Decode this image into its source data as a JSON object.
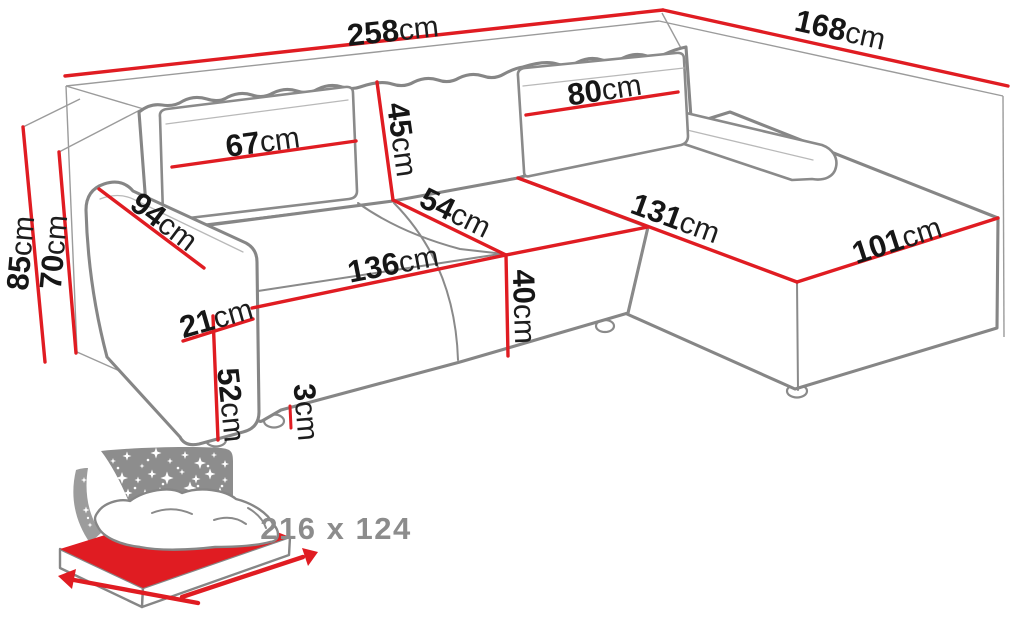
{
  "diagram": {
    "product": "corner-sofa-dimension-diagram",
    "unit": "cm",
    "dimensions": [
      {
        "id": "overall-width",
        "value": "258",
        "unit": "cm"
      },
      {
        "id": "overall-depth",
        "value": "168",
        "unit": "cm"
      },
      {
        "id": "overall-height",
        "value": "85",
        "unit": "cm"
      },
      {
        "id": "backrest-height",
        "value": "70",
        "unit": "cm"
      },
      {
        "id": "back-cushion-width-left",
        "value": "67",
        "unit": "cm"
      },
      {
        "id": "back-cushion-height",
        "value": "45",
        "unit": "cm"
      },
      {
        "id": "back-cushion-width-right",
        "value": "80",
        "unit": "cm"
      },
      {
        "id": "armrest-length",
        "value": "94",
        "unit": "cm"
      },
      {
        "id": "seat-depth",
        "value": "54",
        "unit": "cm"
      },
      {
        "id": "chaise-length",
        "value": "131",
        "unit": "cm"
      },
      {
        "id": "chaise-width",
        "value": "101",
        "unit": "cm"
      },
      {
        "id": "seat-width",
        "value": "136",
        "unit": "cm"
      },
      {
        "id": "seat-height",
        "value": "40",
        "unit": "cm"
      },
      {
        "id": "armrest-width",
        "value": "21",
        "unit": "cm"
      },
      {
        "id": "armrest-height",
        "value": "52",
        "unit": "cm"
      },
      {
        "id": "leg-height",
        "value": "3",
        "unit": "cm"
      }
    ],
    "sleeping_area": {
      "label": "216 x 124",
      "width": "216",
      "length": "124"
    },
    "colors": {
      "dimension_line": "#e01c22",
      "sofa_outline": "#868686",
      "guide_line": "#9b9b9b",
      "label_text": "#161616",
      "sleeping_label": "#8c8c8c",
      "star_panel": "#8d8d8d",
      "mattress": "#e01c22"
    }
  }
}
